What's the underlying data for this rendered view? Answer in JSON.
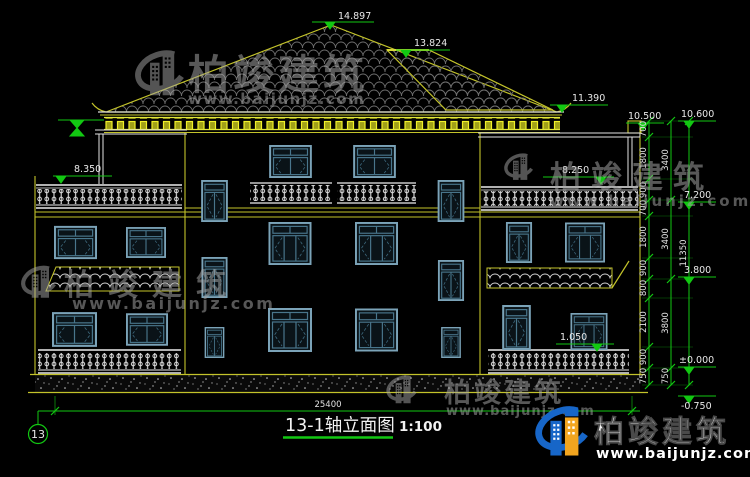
{
  "drawing": {
    "title": "13-1轴立面图",
    "scale": "1:100",
    "axis_bubble": "13",
    "levels": {
      "roof_peak": "14.897",
      "roof_ridge": "13.824",
      "roof_eave": "11.390",
      "terrace_beam_inner": "10.500",
      "terrace_beam_outer": "10.600",
      "left_terrace": "8.350",
      "right_terrace": "8.250",
      "floor3": "7.200",
      "floor2": "3.800",
      "window_sill": "1.050",
      "ground": "±0.000",
      "site": "-0.750"
    },
    "dimensions": {
      "total_width": "25400",
      "chain_inner": [
        "700",
        "1800",
        "900",
        "700",
        "1800",
        "900",
        "800",
        "2100",
        "900",
        "750"
      ],
      "chain_mid": [
        "3400",
        "3400",
        "3800",
        "750"
      ],
      "chain_outer": [
        "11350"
      ]
    }
  },
  "watermark": {
    "brand": "柏竣建筑",
    "website": "www.baijunjz.com"
  },
  "logo": {
    "brand": "柏竣建筑",
    "website": "www.baijunjz.com"
  },
  "icons": {
    "brand_icon": "building-swoosh-logo"
  },
  "colors": {
    "background": "#000000",
    "wall_yellow": "#c3c32a",
    "accent_yellow": "#eeee3a",
    "dimension_green": "#12c812",
    "window_frame": "#7ba3b8",
    "railing_white": "#ececec",
    "logo_blue": "#1766c8",
    "logo_orange": "#f2a51f"
  }
}
